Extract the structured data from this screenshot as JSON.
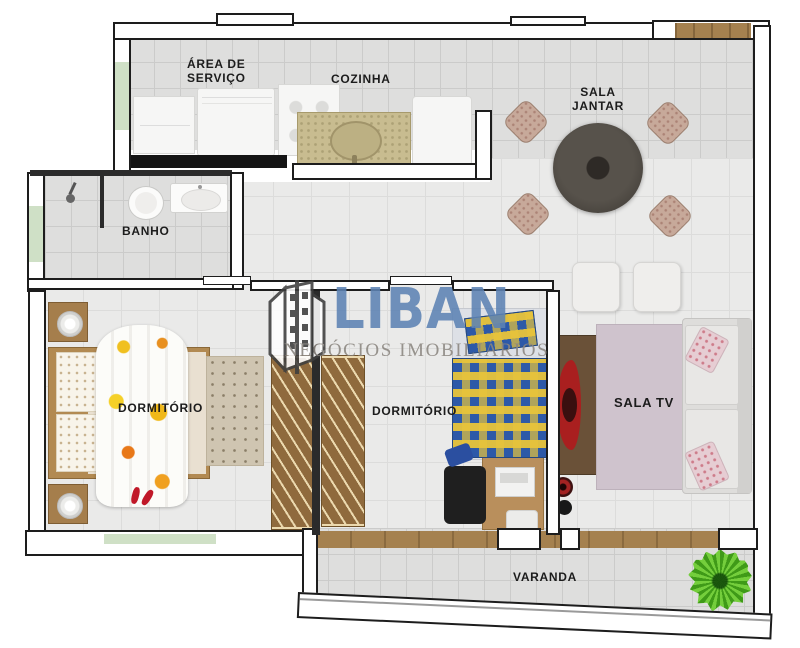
{
  "plan": {
    "type": "apartment-floor-plan",
    "rooms": [
      {
        "key": "area_servico",
        "label": "ÁREA DE\nSERVIÇO"
      },
      {
        "key": "cozinha",
        "label": "COZINHA"
      },
      {
        "key": "sala_jantar",
        "label": "SALA\nJANTAR"
      },
      {
        "key": "banho",
        "label": "BANHO"
      },
      {
        "key": "dormitorio_1",
        "label": "DORMITÓRIO"
      },
      {
        "key": "dormitorio_2",
        "label": "DORMITÓRIO"
      },
      {
        "key": "sala_tv",
        "label": "SALA TV"
      },
      {
        "key": "varanda",
        "label": "VARANDA"
      }
    ],
    "furniture": [
      "laundry-cabinet",
      "washing-machine",
      "stove",
      "granite-counter-sink",
      "refrigerator",
      "round-dining-table",
      "dining-chairs-x4",
      "poufs-x2",
      "entry-door-mat",
      "shower",
      "toilet",
      "bathroom-sink",
      "nightstand-with-lamp-x2",
      "double-bed-floral",
      "rug-beige",
      "wardrobe-x2",
      "single-bed-checkered",
      "desk-with-laptop",
      "office-chair",
      "tv-rack",
      "tv-red",
      "speakers",
      "lavender-rug",
      "sofa-with-cushions",
      "potted-plant"
    ],
    "colors": {
      "wall_outline": "#1d1d1d",
      "window_glass": "#cfe0c6",
      "wood": "#a57e4c",
      "granite_counter": "#c8bc90",
      "bed2_check_blue": "#2d59a8",
      "bed2_check_yellow": "#e8c43a",
      "tv_red": "#a91f1f",
      "rug_lavender": "#cfc3cd",
      "plant_green": "#56b32a"
    }
  },
  "watermark": {
    "brand": "LIBAN",
    "tagline": "NEGÓCIOS IMOBILIÁRIOS",
    "brand_color": "#5d83b4",
    "tagline_color": "#8b8680"
  }
}
